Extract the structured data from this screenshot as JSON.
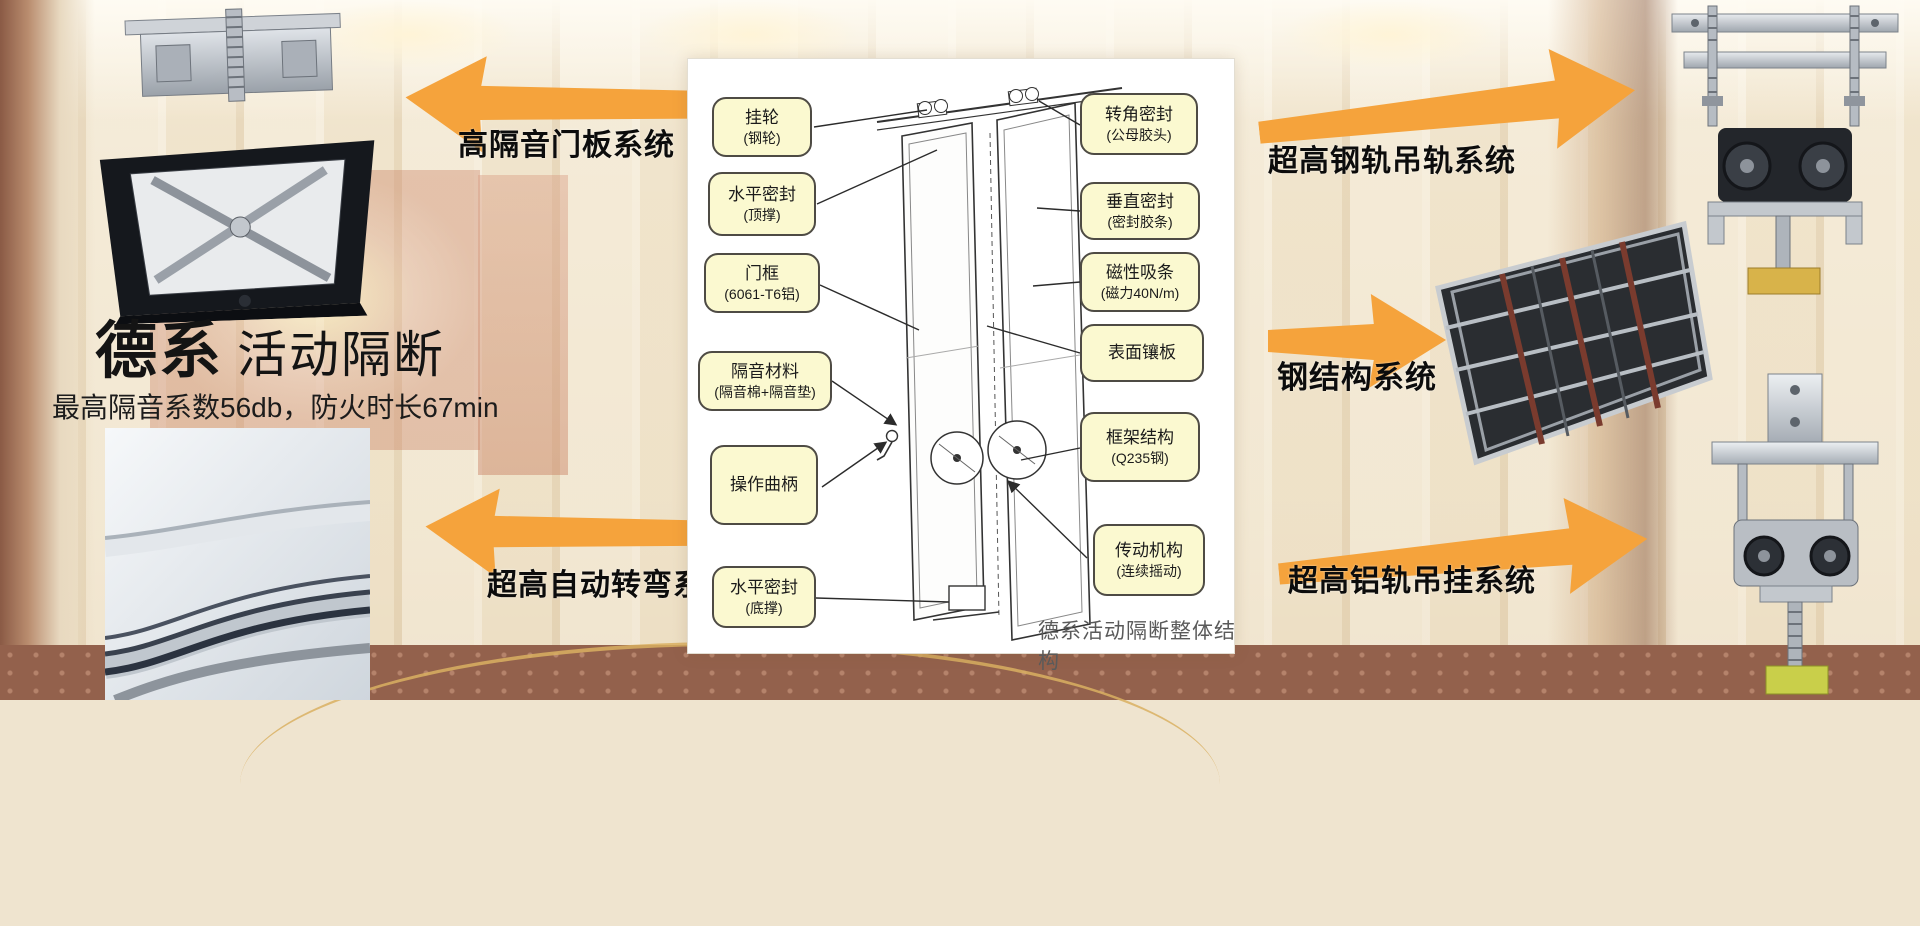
{
  "hero": {
    "title_bold": "德系",
    "title_rest": "活动隔断",
    "subtitle": "最高隔音系数56db，防火时长67min"
  },
  "arrows": {
    "top_left": "高隔音门板系统",
    "bottom_left": "超高自动转弯系统",
    "top_right": "超高钢轨吊轨系统",
    "mid_right": "钢结构系统",
    "bottom_right": "超高铝轨吊挂系统"
  },
  "diagram": {
    "caption": "德系活动隔断整体结构",
    "callouts_left": [
      {
        "line1": "挂轮",
        "line2": "(钢轮)"
      },
      {
        "line1": "水平密封",
        "line2": "(顶撑)"
      },
      {
        "line1": "门框",
        "line2": "(6061-T6铝)"
      },
      {
        "line1": "隔音材料",
        "line2": "(隔音棉+隔音垫)"
      },
      {
        "line1": "操作曲柄",
        "line2": ""
      },
      {
        "line1": "水平密封",
        "line2": "(底撑)"
      }
    ],
    "callouts_right": [
      {
        "line1": "转角密封",
        "line2": "(公母胶头)"
      },
      {
        "line1": "垂直密封",
        "line2": "(密封胶条)"
      },
      {
        "line1": "磁性吸条",
        "line2": "(磁力40N/m)"
      },
      {
        "line1": "表面镶板",
        "line2": ""
      },
      {
        "line1": "框架结构",
        "line2": "(Q235钢)"
      },
      {
        "line1": "传动机构",
        "line2": "(连续摇动)"
      }
    ]
  },
  "colors": {
    "arrow_orange": "#F5A33C",
    "callout_bg": "#FBF9D0",
    "callout_border": "#4E4B44",
    "caption_gray": "#5A5A5A"
  }
}
